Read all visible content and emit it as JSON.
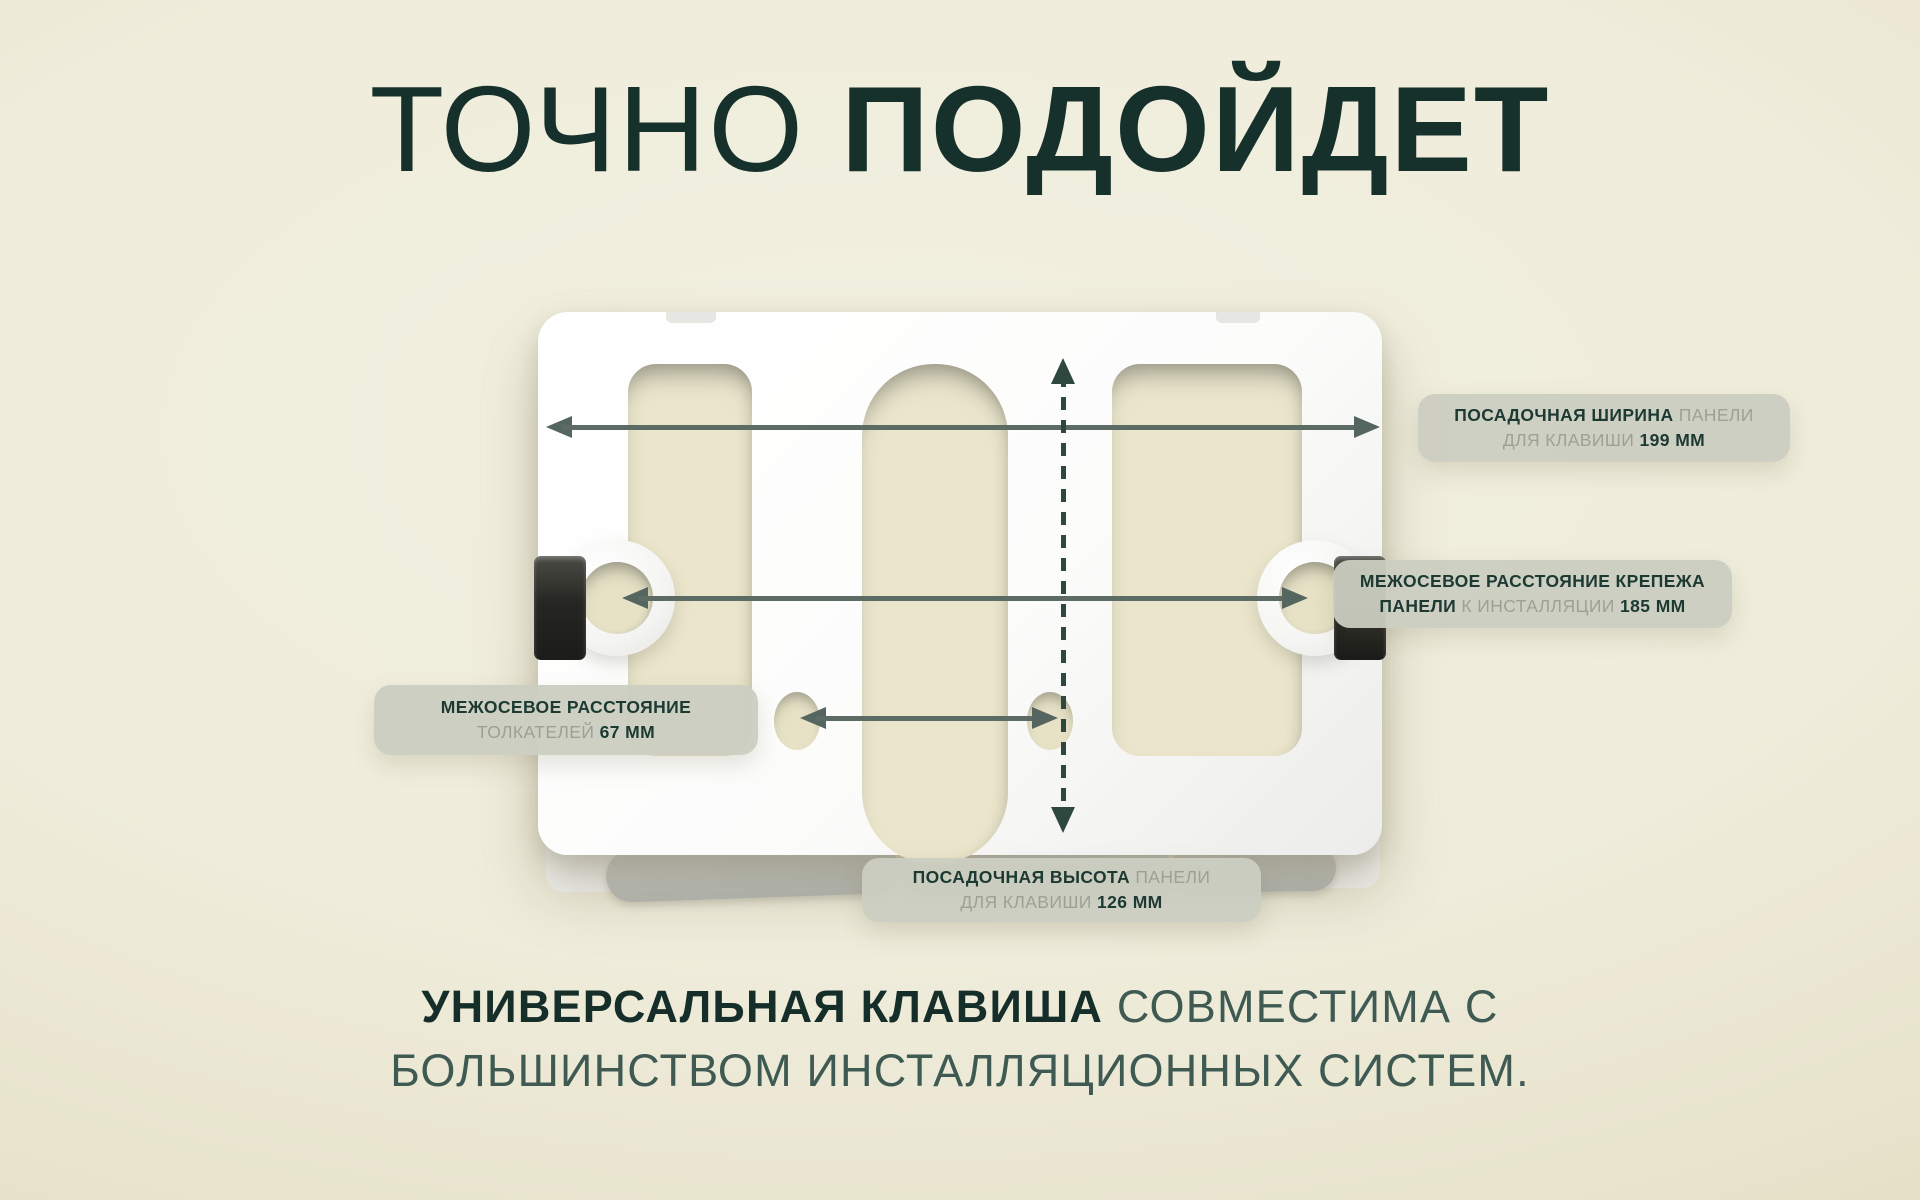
{
  "title": {
    "word_regular": "ТОЧНО",
    "word_bold": "ПОДОЙДЕТ"
  },
  "callouts": {
    "panel_width": {
      "line1_bold": "ПОСАДОЧНАЯ ШИРИНА",
      "line1_light": "ПАНЕЛИ",
      "line2_light": "ДЛЯ КЛАВИШИ",
      "line2_bold": "199 ММ"
    },
    "mount_spacing": {
      "line1_bold": "МЕЖОСЕВОЕ РАССТОЯНИЕ КРЕПЕЖА",
      "line2_bold_a": "ПАНЕЛИ",
      "line2_light": "К ИНСТАЛЛЯЦИИ",
      "line2_bold_b": "185 ММ"
    },
    "pusher_spacing": {
      "line1_bold": "МЕЖОСЕВОЕ РАССТОЯНИЕ",
      "line2_light": "ТОЛКАТЕЛЕЙ",
      "line2_bold": "67 ММ"
    },
    "panel_height": {
      "line1_bold": "ПОСАДОЧНАЯ ВЫСОТА",
      "line1_light": "ПАНЕЛИ",
      "line2_light": "ДЛЯ КЛАВИШИ",
      "line2_bold": "126 ММ"
    }
  },
  "measurements": {
    "panel_width_mm": 199,
    "mount_spacing_mm": 185,
    "pusher_spacing_mm": 67,
    "panel_height_mm": 126
  },
  "tagline": {
    "bold": "УНИВЕРСАЛЬНАЯ КЛАВИША",
    "regular": "СОВМЕСТИМА С",
    "line2": "БОЛЬШИНСТВОМ ИНСТАЛЛЯЦИОННЫХ СИСТЕМ."
  },
  "colors": {
    "background_center": "#f2f0e0",
    "background_edge": "#d9d5b6",
    "accent_dark_green": "#16302b",
    "label_background": "#cbcec1",
    "label_muted_text": "#9da195",
    "arrow_gray_green": "#5c6c64",
    "dashed_arrow_green": "#2e473f",
    "product_white": "#ffffff",
    "cutout_cream": "#eae5cb"
  }
}
